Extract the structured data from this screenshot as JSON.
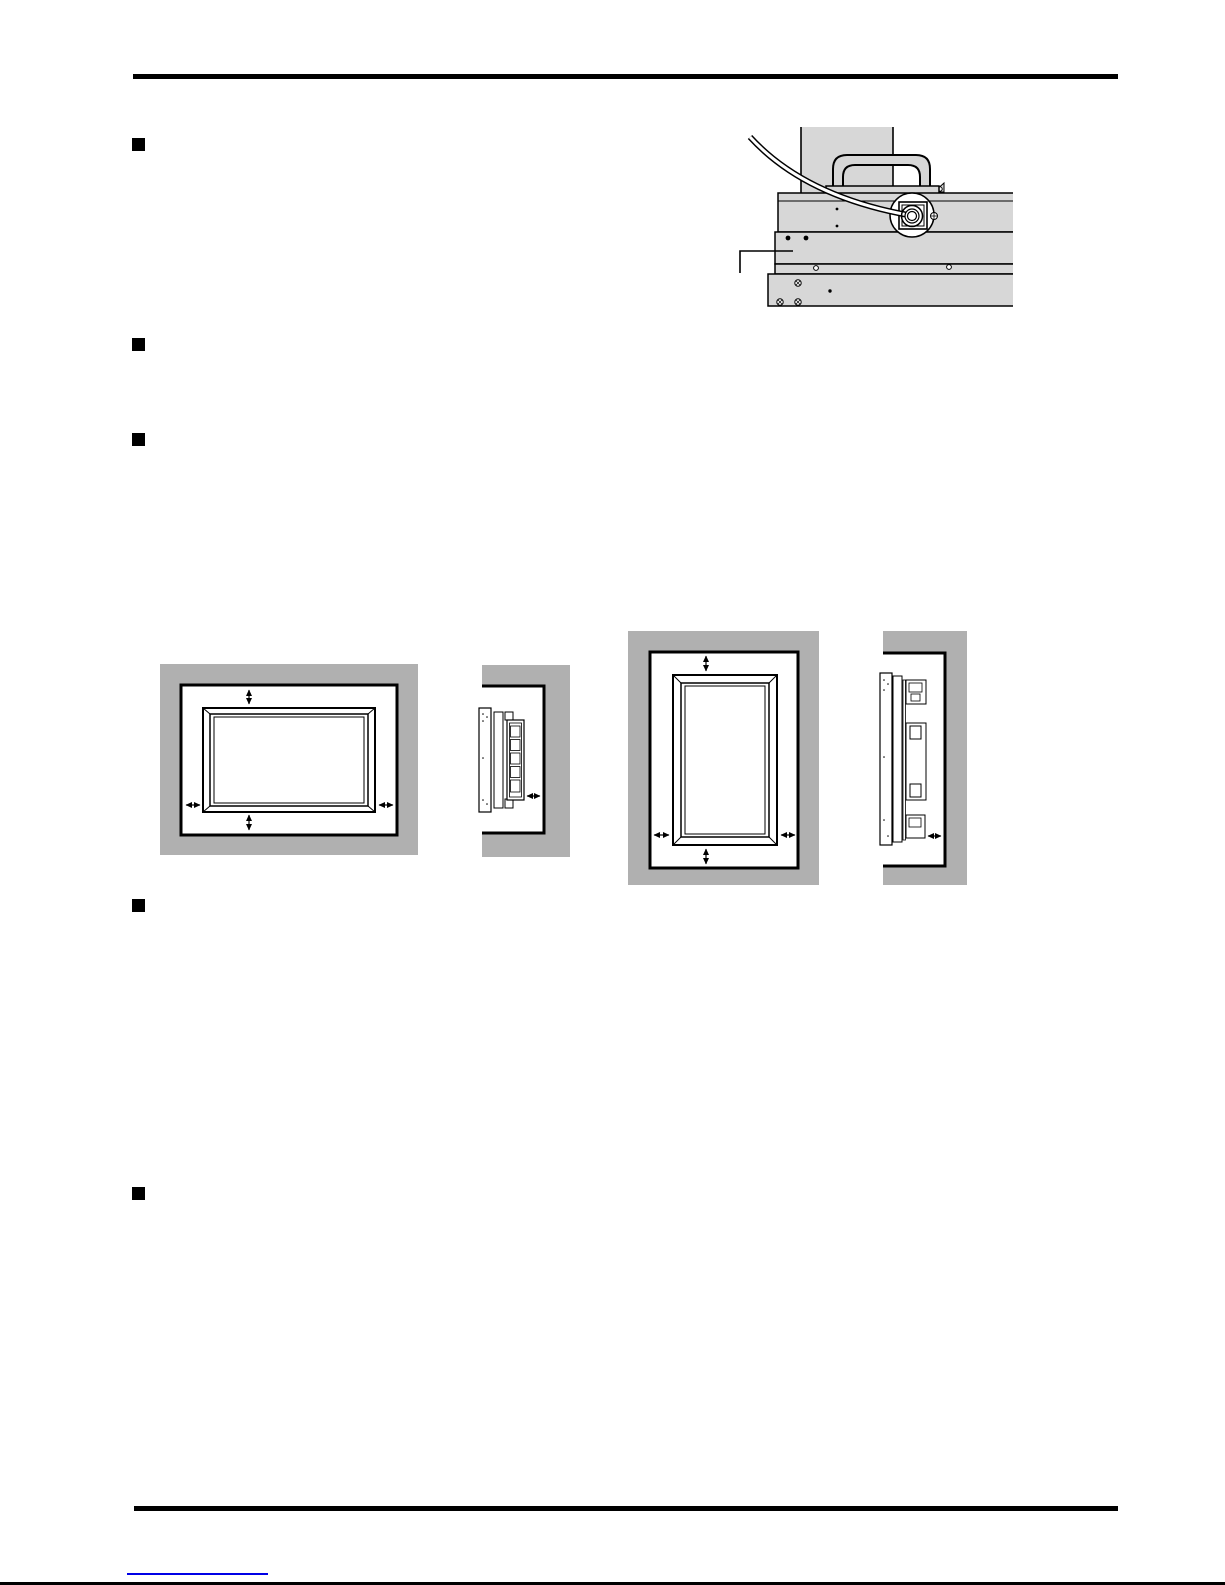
{
  "document": {
    "kind": "manual-page-graphics-only",
    "visible_text": ""
  },
  "colors": {
    "page_bg": "#ffffff",
    "ink": "#000000",
    "wall_gray": "#b0b0b0",
    "device_gray": "#d7d7d7",
    "link_blue": "#0000e6"
  },
  "bullets": {
    "count": 5
  },
  "figures": {
    "cord_clamp": {
      "icon": "rear-panel-cable-clamp-illustration"
    },
    "clearance": {
      "views": [
        {
          "icon": "landscape-front-clearance-diagram"
        },
        {
          "icon": "landscape-side-clearance-diagram"
        },
        {
          "icon": "portrait-front-clearance-diagram"
        },
        {
          "icon": "portrait-side-clearance-diagram"
        }
      ]
    }
  },
  "footer": {
    "link": {
      "text": "",
      "style": "underline-only"
    }
  }
}
